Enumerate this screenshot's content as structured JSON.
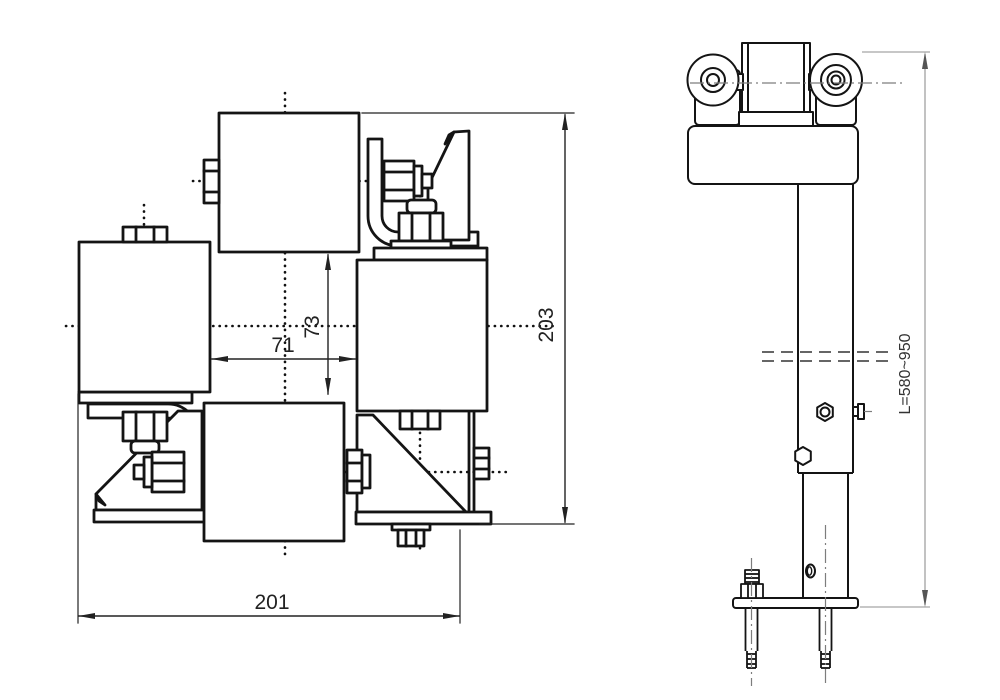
{
  "title": "roller-trolley-technical-drawing",
  "dims": {
    "overall_width": "201",
    "overall_height": "203",
    "horizontal_gap": "71",
    "vertical_gap": "73",
    "post_length": "L=580~950"
  },
  "colors": {
    "line": "#141414",
    "dim_line": "#222222",
    "light_line": "#8f8f8f",
    "background": "#ffffff"
  }
}
